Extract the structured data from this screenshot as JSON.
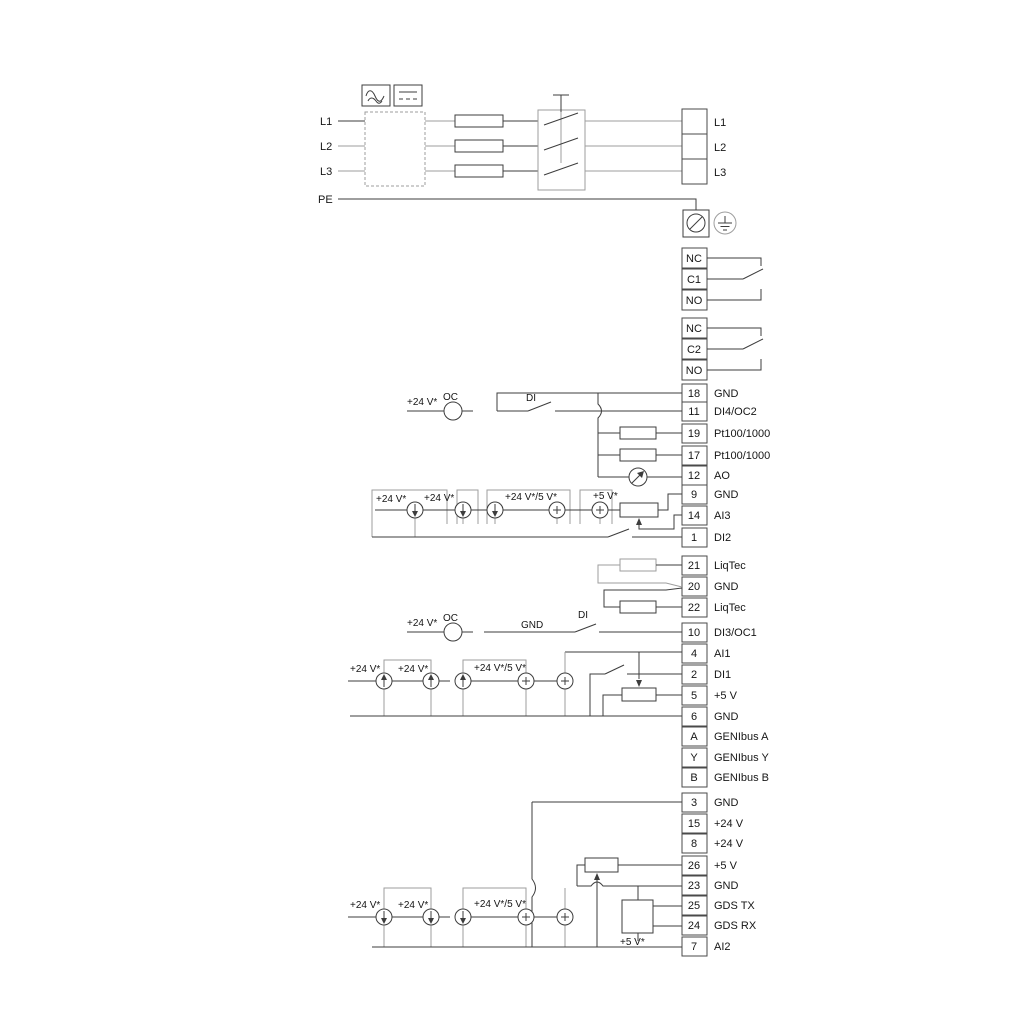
{
  "colors": {
    "wire": "#3d3d3d",
    "option_wire": "#9e9e9e",
    "text": "#161616",
    "background": "#ffffff"
  },
  "power": {
    "inputs": [
      "L1",
      "L2",
      "L3",
      "PE"
    ],
    "outputs": [
      "L1",
      "L2",
      "L3"
    ]
  },
  "relay1": [
    "NC",
    "C1",
    "NO"
  ],
  "relay2": [
    "NC",
    "C2",
    "NO"
  ],
  "io_top": [
    [
      "18",
      "GND"
    ],
    [
      "11",
      "DI4/OC2"
    ],
    [
      "19",
      "Pt100/1000"
    ],
    [
      "17",
      "Pt100/1000"
    ],
    [
      "12",
      "AO"
    ],
    [
      "9",
      "GND"
    ],
    [
      "14",
      "AI3"
    ],
    [
      "1",
      "DI2"
    ]
  ],
  "liqtec": [
    [
      "21",
      "LiqTec"
    ],
    [
      "20",
      "GND"
    ],
    [
      "22",
      "LiqTec"
    ]
  ],
  "di3": [
    [
      "10",
      "DI3/OC1"
    ]
  ],
  "io_mid": [
    [
      "4",
      "AI1"
    ],
    [
      "2",
      "DI1"
    ],
    [
      "5",
      "+5 V"
    ],
    [
      "6",
      "GND"
    ],
    [
      "A",
      "GENIbus A"
    ],
    [
      "Y",
      "GENIbus Y"
    ],
    [
      "B",
      "GENIbus B"
    ]
  ],
  "io_bottom": [
    [
      "3",
      "GND"
    ],
    [
      "15",
      "+24 V"
    ],
    [
      "8",
      "+24 V"
    ],
    [
      "26",
      "+5 V"
    ],
    [
      "23",
      "GND"
    ],
    [
      "25",
      "GDS TX"
    ],
    [
      "24",
      "GDS RX"
    ],
    [
      "7",
      "AI2"
    ]
  ],
  "labels": {
    "v24": "+24 V*",
    "v24_5": "+24 V*/5 V*",
    "v5": "+5 V*",
    "oc": "OC",
    "di": "DI",
    "gnd": "GND"
  }
}
